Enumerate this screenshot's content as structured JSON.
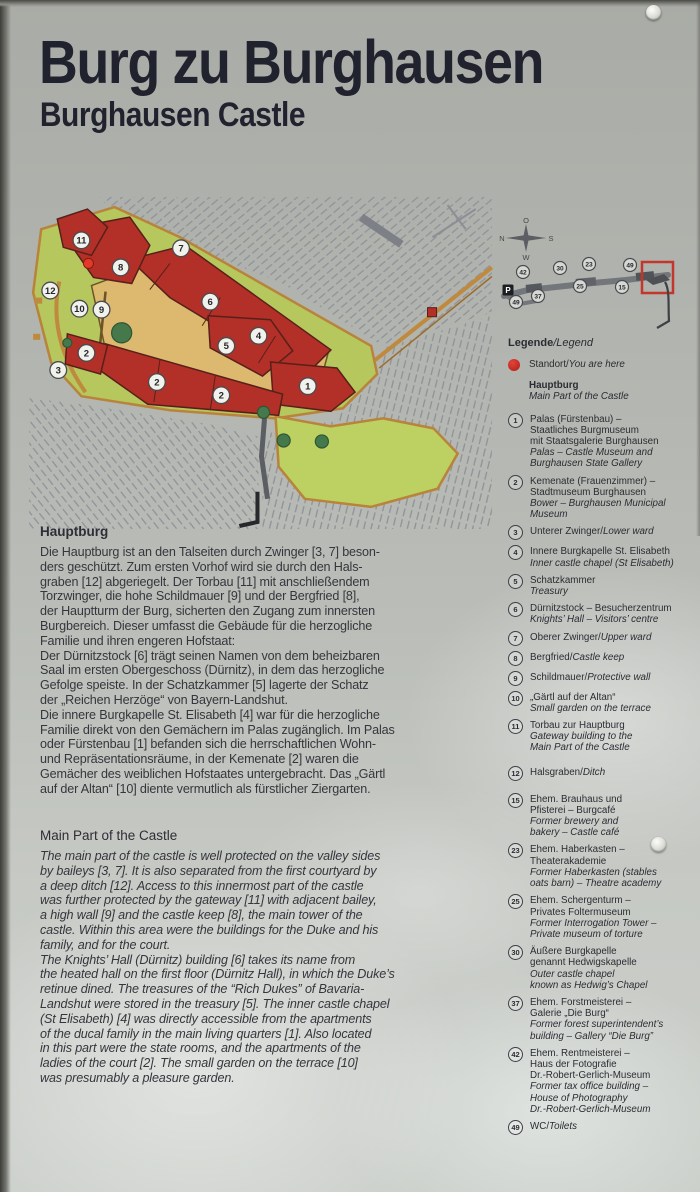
{
  "title": {
    "de": "Burg zu Burghausen",
    "en": "Burghausen Castle"
  },
  "map": {
    "numbers": [
      {
        "n": "11",
        "x": 52,
        "y": 43
      },
      {
        "n": "8",
        "x": 91,
        "y": 70
      },
      {
        "n": "7",
        "x": 151,
        "y": 51
      },
      {
        "n": "12",
        "x": 21,
        "y": 93
      },
      {
        "n": "10",
        "x": 50,
        "y": 111
      },
      {
        "n": "9",
        "x": 72,
        "y": 112
      },
      {
        "n": "6",
        "x": 180,
        "y": 104
      },
      {
        "n": "5",
        "x": 196,
        "y": 148
      },
      {
        "n": "4",
        "x": 228,
        "y": 138
      },
      {
        "n": "2",
        "x": 57,
        "y": 155
      },
      {
        "n": "3",
        "x": 29,
        "y": 172
      },
      {
        "n": "2",
        "x": 127,
        "y": 184
      },
      {
        "n": "2",
        "x": 191,
        "y": 197
      },
      {
        "n": "1",
        "x": 277,
        "y": 188
      }
    ],
    "you_are_here": {
      "x": 59,
      "y": 66
    },
    "colors": {
      "building": "#b23028",
      "courtyard": "#dcb96f",
      "green": "#b6c75e",
      "bright_green": "#bdd162",
      "wall": "#c08a3e",
      "tree": "#45794c",
      "hatch": "#90939a",
      "marker_red": "#e23a2a"
    }
  },
  "overview": {
    "compass": {
      "top": "O",
      "left": "N",
      "right": "S",
      "bottom": "W"
    },
    "markers": [
      {
        "n": "42",
        "x": 25,
        "y": 54
      },
      {
        "n": "30",
        "x": 62,
        "y": 50
      },
      {
        "n": "23",
        "x": 91,
        "y": 46
      },
      {
        "n": "49",
        "x": 132,
        "y": 47
      },
      {
        "n": "P",
        "x": 10,
        "y": 72,
        "type": "parking"
      },
      {
        "n": "49",
        "x": 18,
        "y": 84
      },
      {
        "n": "37",
        "x": 40,
        "y": 78
      },
      {
        "n": "25",
        "x": 82,
        "y": 68
      },
      {
        "n": "15",
        "x": 124,
        "y": 69
      }
    ],
    "highlight_color": "#c3362b"
  },
  "legend": {
    "title_de": "Legende",
    "title_en": "/Legend",
    "standort_de": "Standort/",
    "standort_en": "You are here",
    "hauptburg_de": "Hauptburg",
    "hauptburg_en": "Main Part of the Castle",
    "items": [
      {
        "num": "1",
        "de": "Palas (Fürstenbau) –\nStaatliches Burgmuseum\nmit Staatsgalerie Burghausen\n",
        "en": "Palas – Castle Museum and\nBurghausen State Gallery"
      },
      {
        "num": "2",
        "de": "Kemenate (Frauenzimmer) –\nStadtmuseum Burghausen\n",
        "en": "Bower – Burghausen Municipal\nMuseum"
      },
      {
        "num": "3",
        "de": "Unterer Zwinger/",
        "en": "Lower ward"
      },
      {
        "num": "4",
        "de": "Innere Burgkapelle St. Elisabeth\n",
        "en": "Inner castle chapel (St Elisabeth)"
      },
      {
        "num": "5",
        "de": "Schatzkammer\n",
        "en": "Treasury"
      },
      {
        "num": "6",
        "de": "Dürnitzstock – Besucherzentrum\n",
        "en": "Knights’ Hall – Visitors’ centre"
      },
      {
        "num": "7",
        "de": "Oberer Zwinger/",
        "en": "Upper ward"
      },
      {
        "num": "8",
        "de": "Bergfried/",
        "en": "Castle keep"
      },
      {
        "num": "9",
        "de": "Schildmauer/",
        "en": "Protective wall"
      },
      {
        "num": "10",
        "de": "„Gärtl auf der Altan“\n",
        "en": "Small garden on the terrace"
      },
      {
        "num": "11",
        "de": "Torbau zur Hauptburg\n",
        "en": "Gateway building to the\nMain Part of the Castle"
      },
      {
        "num": "12",
        "de": "Halsgraben/",
        "en": "Ditch"
      },
      {
        "num": "15",
        "de": "Ehem. Brauhaus und\nPfisterei – Burgcafé\n",
        "en": "Former brewery and\nbakery – Castle café"
      },
      {
        "num": "23",
        "de": "Ehem. Haberkasten –\nTheaterakademie\n",
        "en": "Former Haberkasten (stables\noats barn) – Theatre academy"
      },
      {
        "num": "25",
        "de": "Ehem. Schergenturm –\nPrivates Foltermuseum\n",
        "en": "Former Interrogation Tower –\nPrivate museum of torture"
      },
      {
        "num": "30",
        "de": "Äußere Burgkapelle\ngenannt Hedwigskapelle\n",
        "en": "Outer castle chapel\nknown as Hedwig’s Chapel"
      },
      {
        "num": "37",
        "de": "Ehem. Forstmeisterei –\nGalerie „Die Burg“\n",
        "en": "Former forest superintendent’s\nbuilding – Gallery “Die Burg”"
      },
      {
        "num": "42",
        "de": "Ehem. Rentmeisterei –\nHaus der Fotografie\nDr.-Robert-Gerlich-Museum\n",
        "en": "Former tax office building –\nHouse of Photography\nDr.-Robert-Gerlich-Museum"
      },
      {
        "num": "49",
        "de": "WC/",
        "en": "Toilets"
      }
    ]
  },
  "sections": {
    "de": {
      "heading": "Hauptburg",
      "body": "Die Hauptburg ist an den Talseiten durch Zwinger [3, 7] beson-\nders geschützt. Zum ersten Vorhof wird sie durch den Hals-\ngraben [12] abgeriegelt. Der Torbau [11] mit anschließendem\nTorzwinger, die hohe Schildmauer [9] und der Bergfried [8],\nder Hauptturm der Burg, sicherten den Zugang zum innersten\nBurgbereich. Dieser umfasst die Gebäude für die herzogliche\nFamilie und ihren engeren Hofstaat:\nDer Dürnitzstock [6] trägt seinen Namen von dem beheizbaren\nSaal im ersten Obergeschoss (Dürnitz), in dem das herzogliche\nGefolge speiste. In der Schatzkammer [5] lagerte der Schatz\nder „Reichen Herzöge“ von Bayern-Landshut.\nDie innere Burgkapelle St. Elisabeth [4] war für die herzogliche\nFamilie direkt von den Gemächern im Palas zugänglich. Im Palas\noder Fürstenbau [1] befanden sich die herrschaftlichen Wohn-\nund Repräsentationsräume, in der Kemenate [2] waren die\nGemächer des weiblichen Hofstaates untergebracht. Das „Gärtl\nauf der Altan“ [10] diente vermutlich als fürstlicher Ziergarten."
    },
    "en": {
      "heading": "Main Part of the Castle",
      "body": "The main part of the castle is well protected on the valley sides\nby baileys [3, 7]. It is also separated from the first courtyard by\na deep ditch [12]. Access to this innermost part of the castle\nwas further protected by the gateway [11] with adjacent bailey,\na high wall [9] and the castle keep [8], the main tower of the\ncastle. Within this area were the buildings for the Duke and his\nfamily, and for the court.\nThe Knights’ Hall (Dürnitz) building [6] takes its name from\nthe heated hall on the first floor (Dürnitz Hall), in which the Duke’s\nretinue dined. The treasures of the “Rich Dukes” of Bavaria-\nLandshut were stored in the treasury [5]. The inner castle chapel\n(St Elisabeth) [4] was directly accessible from the apartments\nof the ducal family in the main living quarters [1]. Also located\nin this part were the state rooms, and the apartments of the\nladies of the court [2]. The small garden on the terrace [10]\nwas presumably a pleasure garden."
    }
  }
}
